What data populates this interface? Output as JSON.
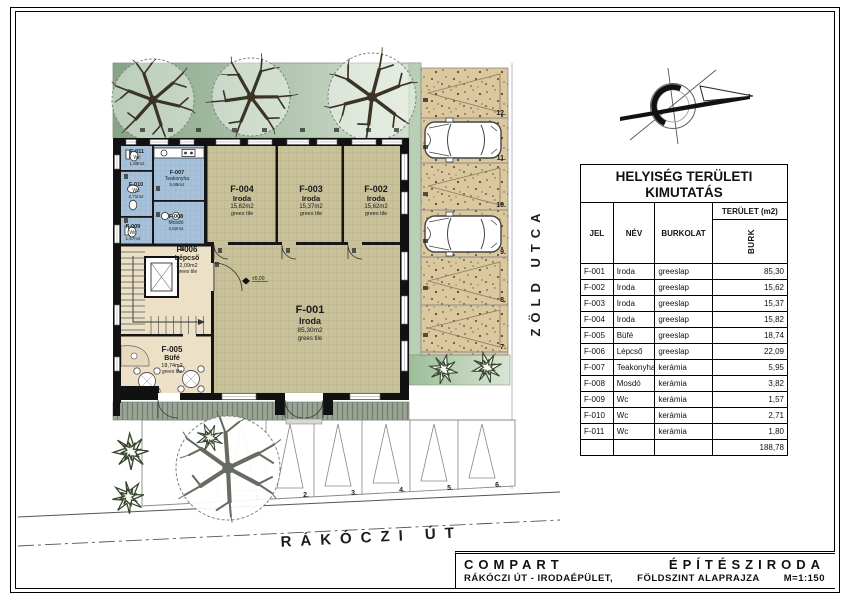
{
  "drawing": {
    "streets": {
      "right_street": "ZÖLD UTCA",
      "bottom_street": "RÁKÓCZI ÚT"
    },
    "level_marker": "±0,00",
    "parking_right": [
      "12.",
      "11.",
      "10.",
      "9.",
      "8.",
      "7."
    ],
    "parking_bottom": [
      "1.",
      "2.",
      "3.",
      "4.",
      "5.",
      "6."
    ],
    "rooms": [
      {
        "id": "F-001",
        "name": "Iroda",
        "area": "85,30m2",
        "floor": "grees tile"
      },
      {
        "id": "F-002",
        "name": "Iroda",
        "area": "15,62m2",
        "floor": "grees tile"
      },
      {
        "id": "F-003",
        "name": "Iroda",
        "area": "15,37m2",
        "floor": "grees tile"
      },
      {
        "id": "F-004",
        "name": "Iroda",
        "area": "15,82m2",
        "floor": "grees tile"
      },
      {
        "id": "F-005",
        "name": "Büfé",
        "area": "18,74m2",
        "floor": "grees tile"
      },
      {
        "id": "F-006",
        "name": "Lépcső",
        "area": "22,09m2",
        "floor": "grees tile"
      },
      {
        "id": "F-007",
        "name": "Teakonyha",
        "area": "5,95m2"
      },
      {
        "id": "F-008",
        "name": "Mosdó",
        "area": "3,82m2"
      },
      {
        "id": "F-009",
        "name": "Wc",
        "area": "1,57m2"
      },
      {
        "id": "F-010",
        "name": "Wc",
        "area": "2,71m2"
      },
      {
        "id": "F-011",
        "name": "Wc",
        "area": "1,80m2"
      }
    ],
    "colors": {
      "office_floor": "#c8c19a",
      "wet_floor": "#a6c1d9",
      "parking": "#dcc89e",
      "green": "#9cbd98"
    }
  },
  "area_table": {
    "title_line1": "HELYISÉG TERÜLETI",
    "title_line2": "KIMUTATÁS",
    "col_jel": "JEL",
    "col_nev": "NÉV",
    "col_burkolat": "BURKOLAT",
    "col_terulet": "TERÜLET (m2)",
    "col_burk": "BURK",
    "rows": [
      {
        "jel": "F-001",
        "nev": "Iroda",
        "burkolat": "greeslap",
        "terulet": "85,30"
      },
      {
        "jel": "F-002",
        "nev": "Iroda",
        "burkolat": "greeslap",
        "terulet": "15,62"
      },
      {
        "jel": "F-003",
        "nev": "Iroda",
        "burkolat": "greeslap",
        "terulet": "15,37"
      },
      {
        "jel": "F-004",
        "nev": "Iroda",
        "burkolat": "greeslap",
        "terulet": "15,82"
      },
      {
        "jel": "F-005",
        "nev": "Büfé",
        "burkolat": "greeslap",
        "terulet": "18,74"
      },
      {
        "jel": "F-006",
        "nev": "Lépcső",
        "burkolat": "greeslap",
        "terulet": "22,09"
      },
      {
        "jel": "F-007",
        "nev": "Teakonyha",
        "burkolat": "kerámia",
        "terulet": "5,95"
      },
      {
        "jel": "F-008",
        "nev": "Mosdó",
        "burkolat": "kerámia",
        "terulet": "3,82"
      },
      {
        "jel": "F-009",
        "nev": "Wc",
        "burkolat": "kerámia",
        "terulet": "1,57"
      },
      {
        "jel": "F-010",
        "nev": "Wc",
        "burkolat": "kerámia",
        "terulet": "2,71"
      },
      {
        "jel": "F-011",
        "nev": "Wc",
        "burkolat": "kerámia",
        "terulet": "1,80"
      }
    ],
    "total": "188,78"
  },
  "titleblock": {
    "company_left": "COMPART",
    "company_right": "ÉPÍTÉSZIRODA",
    "project": "RÁKÓCZI ÚT - IRODAÉPÜLET,",
    "drawing_name": "FÖLDSZINT ALAPRAJZA",
    "scale": "M=1:150"
  }
}
